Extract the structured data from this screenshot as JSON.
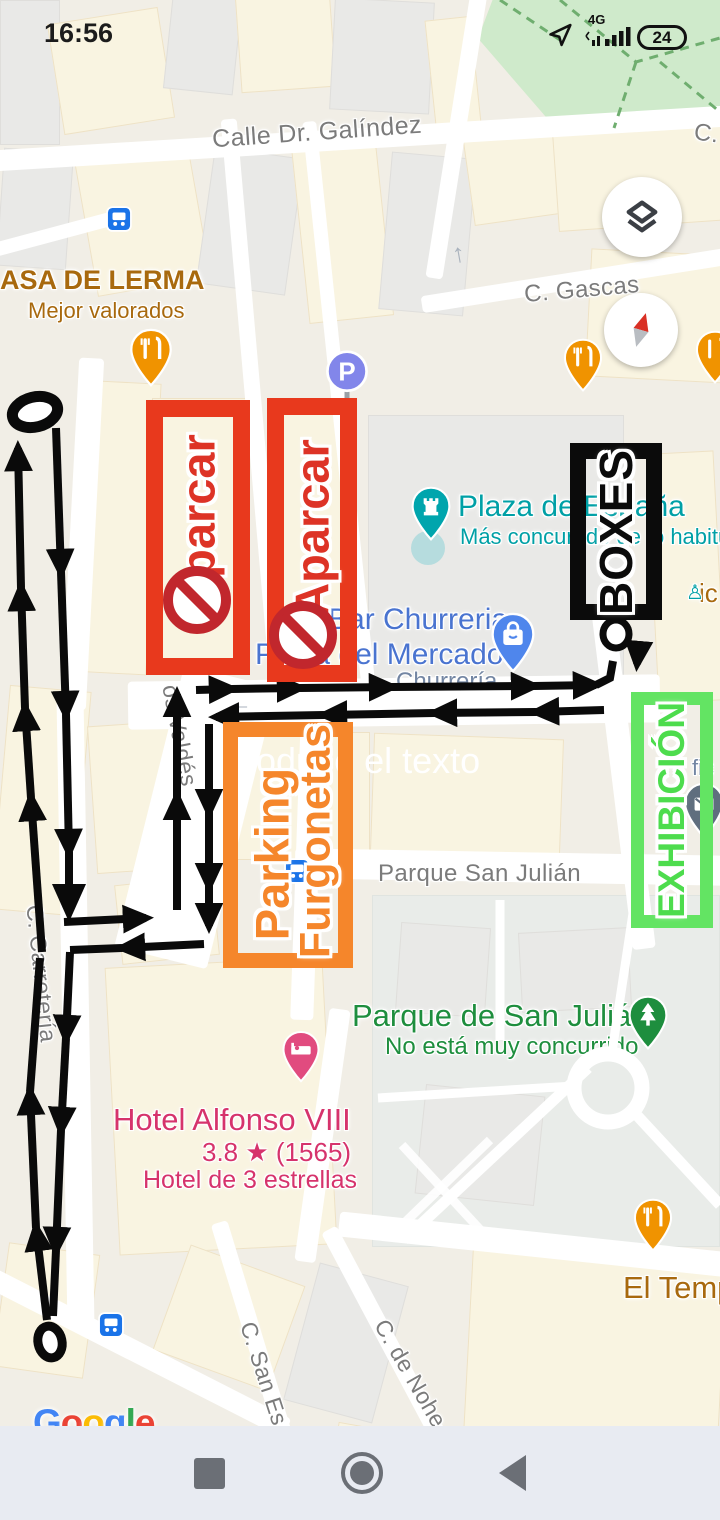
{
  "status_bar": {
    "time": "16:56",
    "network_label": "4G",
    "battery_level": "24"
  },
  "map_labels": {
    "galindez": "Calle Dr. Galíndez",
    "c_short": "C.",
    "gascas": "C. Gascas",
    "carreteria": "C. Carretería",
    "valdes": "os Valdés",
    "san_julian_street": "Parque San Julián",
    "san_esteban": "C. San Es",
    "noheda": "C. de Nohe",
    "lerma": "ASA DE LERMA",
    "lerma_sub": "Mejor valorados",
    "plaza_espana": "Plaza de España",
    "plaza_espana_sub": "Más concurrido de lo habitual",
    "bar_churreria": "Bar Churreria",
    "plaza_mercado": "Plaza del Mercado",
    "churreria_sub": "Churrería",
    "ic_partial": "ic",
    "fic_partial": "fic",
    "parque": "Parque de San Julián",
    "parque_sub": "No está muy concurrido",
    "hotel": "Hotel Alfonso VIII",
    "hotel_rating": "3.8 ★ (1565)",
    "hotel_sub": "Hotel de 3 estrellas",
    "el_templo": "El Temp"
  },
  "annotations": {
    "aparcar_1": "Aparcar",
    "aparcar_2": "Aparcar",
    "boxes": "BOXES",
    "exhibicion": "EXHIBICIÓN",
    "parking_line_1": "Parking",
    "parking_line_2": "Furgonetas",
    "ghost_text": "Introduce el texto",
    "colors": {
      "red": "#e8391d",
      "red_text": "#dd3326",
      "orange": "#f5862b",
      "green": "#63e463",
      "green_text": "#4ddc4d",
      "black": "#0b0b0b",
      "route": "#0a0a0a",
      "prohibition": "#c1272d"
    }
  },
  "google_logo": {
    "letters": [
      {
        "ch": "G",
        "color": "#4285F4"
      },
      {
        "ch": "o",
        "color": "#EA4335"
      },
      {
        "ch": "o",
        "color": "#FBBC05"
      },
      {
        "ch": "g",
        "color": "#4285F4"
      },
      {
        "ch": "l",
        "color": "#34A853"
      },
      {
        "ch": "e",
        "color": "#EA4335"
      }
    ]
  },
  "nav": {
    "buttons": [
      "recents",
      "home",
      "back"
    ]
  }
}
